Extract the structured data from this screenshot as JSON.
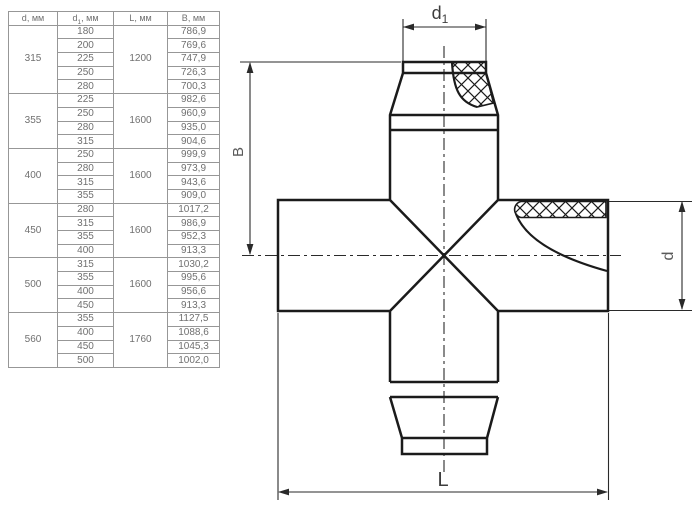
{
  "table": {
    "headers": [
      {
        "base": "d",
        "sub": "",
        "suffix": ", мм"
      },
      {
        "base": "d",
        "sub": "1",
        "suffix": ", мм"
      },
      {
        "base": "L",
        "sub": "",
        "suffix": ", мм"
      },
      {
        "base": "B",
        "sub": "",
        "suffix": ", мм"
      }
    ],
    "groups": [
      {
        "d": "315",
        "L": "1200",
        "rows": [
          [
            "180",
            "786,9"
          ],
          [
            "200",
            "769,6"
          ],
          [
            "225",
            "747,9"
          ],
          [
            "250",
            "726,3"
          ],
          [
            "280",
            "700,3"
          ]
        ]
      },
      {
        "d": "355",
        "L": "1600",
        "rows": [
          [
            "225",
            "982,6"
          ],
          [
            "250",
            "960,9"
          ],
          [
            "280",
            "935,0"
          ],
          [
            "315",
            "904,6"
          ]
        ]
      },
      {
        "d": "400",
        "L": "1600",
        "rows": [
          [
            "250",
            "999,9"
          ],
          [
            "280",
            "973,9"
          ],
          [
            "315",
            "943,6"
          ],
          [
            "355",
            "909,0"
          ]
        ]
      },
      {
        "d": "450",
        "L": "1600",
        "rows": [
          [
            "280",
            "1017,2"
          ],
          [
            "315",
            "986,9"
          ],
          [
            "355",
            "952,3"
          ],
          [
            "400",
            "913,3"
          ]
        ]
      },
      {
        "d": "500",
        "L": "1600",
        "rows": [
          [
            "315",
            "1030,2"
          ],
          [
            "355",
            "995,6"
          ],
          [
            "400",
            "956,6"
          ],
          [
            "450",
            "913,3"
          ]
        ]
      },
      {
        "d": "560",
        "L": "1760",
        "rows": [
          [
            "355",
            "1127,5"
          ],
          [
            "400",
            "1088,6"
          ],
          [
            "450",
            "1045,3"
          ],
          [
            "500",
            "1002,0"
          ]
        ]
      }
    ]
  },
  "diagram": {
    "labels": {
      "top": {
        "base": "d",
        "sub": "1"
      },
      "left": "B",
      "right": "d",
      "bottom": "L"
    }
  },
  "colors": {
    "line": "#1b1b1b",
    "dim": "#2a2a2a",
    "tborder": "#979797",
    "ttext": "#707070",
    "label": "#3d3d3d",
    "label-light": "#5a5a5a",
    "bg": "#ffffff"
  }
}
